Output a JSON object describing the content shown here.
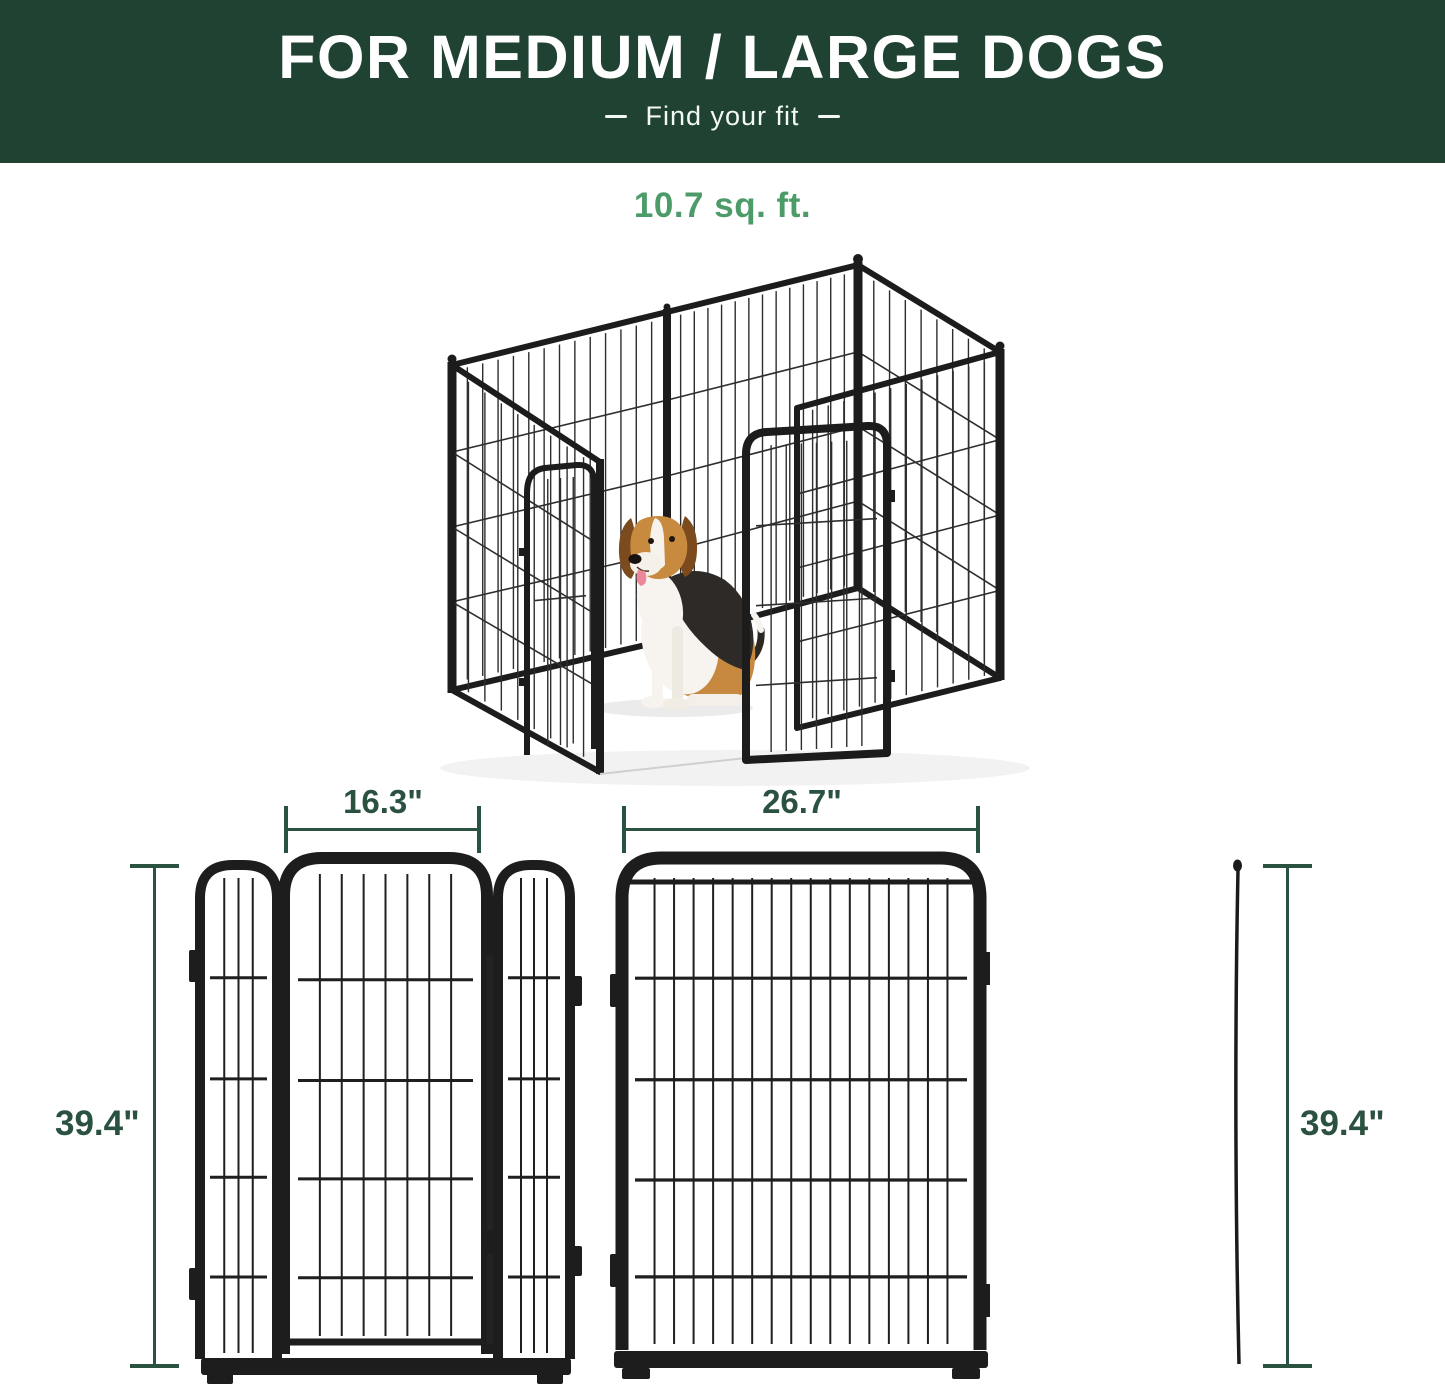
{
  "header": {
    "title": "FOR MEDIUM / LARGE DOGS",
    "subtitle": "Find your fit"
  },
  "illustration": {
    "area_label": "10.7 sq. ft."
  },
  "dimensions": {
    "height_left": "39.4\"",
    "door_panel_width": "16.3\"",
    "wide_panel_width": "26.7\"",
    "height_right": "39.4\""
  },
  "colors": {
    "header_background": "#204233",
    "dimension_green": "#2b5141",
    "area_label_green": "#4c9b68",
    "metal_black": "#1d1d1d"
  }
}
